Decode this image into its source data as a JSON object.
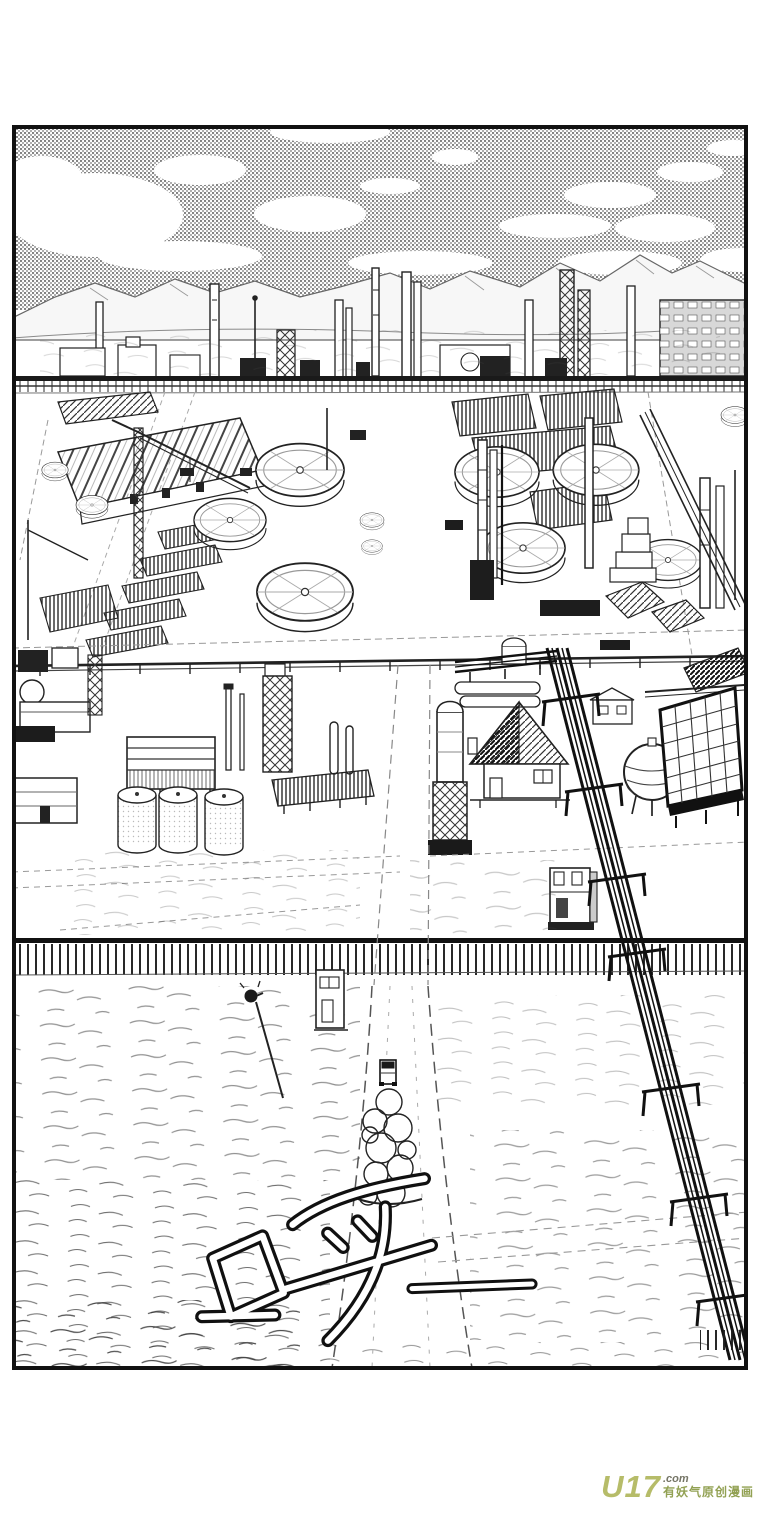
{
  "page": {
    "background_color": "#ffffff"
  },
  "panel": {
    "border_color": "#111111"
  },
  "sfx": {
    "text": "呼",
    "trailing_dash": "——"
  },
  "watermark": {
    "brand": "U17",
    "suffix": ".com",
    "tagline": "有妖气原创漫画",
    "brand_color": "#b3b961",
    "suffix_color": "#6e6e5e",
    "tagline_color": "#8d9c4a"
  }
}
